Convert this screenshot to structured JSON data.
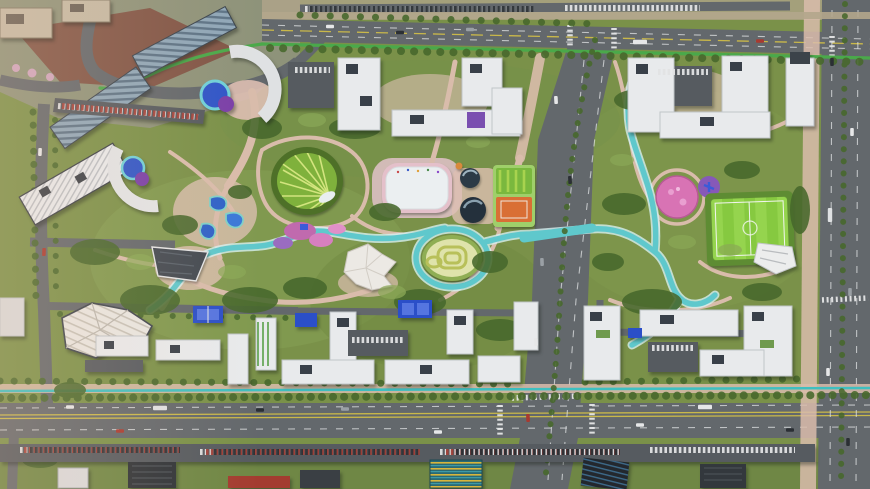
{
  "page": {
    "title": "Aerial masterplan render — residential district with central park"
  },
  "palette": {
    "park_green_base": "#7a9149",
    "tree_dark": "#47682c",
    "tree_light": "#8ba957",
    "hedge_green": "#567c33",
    "median_green": "#5d8036",
    "road_asphalt": "#63686c",
    "parking_asphalt": "#565b60",
    "sidewalk_tan": "#b3a68c",
    "lane_yellow": "#c9b84a",
    "path_pink": "#d9bcab",
    "plaza_pink": "#ddbfb2",
    "stream_teal": "#5fc8cc",
    "bike_green": "#4aa94a",
    "rink_white": "#ebeff1",
    "rink_apron": "#e4c0ca",
    "lawn_green": "#7fb13c",
    "lawn_stripe": "#dcea86",
    "lawn_rim": "#4e7028",
    "court_green": "#7ab83e",
    "court_orange": "#d96f35",
    "court_blue": "#2b4fc8",
    "field_green": "#86c940",
    "field_stripe": "#95d44e",
    "circle_pink": "#d873b4",
    "circle_purple": "#8659b8",
    "maze_hedge": "#b8c05a",
    "maze_bg": "#dfe3ab",
    "building_white": "#e8eaec",
    "building_tan": "#c4b9a4",
    "glass_blue": "#8fa7b8",
    "roof_dark": "#3a4047",
    "school_roof": "#e9e7e2",
    "brick_plaza": "#7e473b",
    "industrial_dark": "#2e3338",
    "industrial_red": "#a33c30",
    "market_teal": "#2a6a74",
    "pavilion_dark": "#2c3a46",
    "car_white": "#e6e7e8",
    "car_dark": "#2b2f34",
    "car_red": "#a83a30",
    "car_silver": "#9aa0a5"
  },
  "legend": [
    {
      "feature": "event-lawn-amphitheater",
      "color_key": "lawn_green"
    },
    {
      "feature": "ice-rink",
      "color_key": "rink_white"
    },
    {
      "feature": "round-dark-pavilions",
      "color_key": "pavilion_dark"
    },
    {
      "feature": "multisport-court-green",
      "color_key": "court_green"
    },
    {
      "feature": "multisport-court-orange",
      "color_key": "court_orange"
    },
    {
      "feature": "hedge-maze-garden",
      "color_key": "maze_hedge"
    },
    {
      "feature": "origami-pavilion",
      "color_key": "school_roof"
    },
    {
      "feature": "playground-mounds",
      "color_key": "circle_pink"
    },
    {
      "feature": "pink-playground-circle",
      "color_key": "circle_pink"
    },
    {
      "feature": "purple-playground-circle",
      "color_key": "circle_purple"
    },
    {
      "feature": "soccer-field",
      "color_key": "field_green"
    },
    {
      "feature": "basketball-courts",
      "color_key": "court_blue"
    },
    {
      "feature": "park-stream-greenway",
      "color_key": "stream_teal"
    },
    {
      "feature": "pedestrian-paths",
      "color_key": "path_pink"
    },
    {
      "feature": "cycle-lane",
      "color_key": "bike_green"
    },
    {
      "feature": "north-boulevard",
      "color_key": "road_asphalt"
    },
    {
      "feature": "south-boulevard",
      "color_key": "road_asphalt"
    },
    {
      "feature": "central-avenue",
      "color_key": "road_asphalt"
    },
    {
      "feature": "east-avenue",
      "color_key": "road_asphalt"
    },
    {
      "feature": "residential-blocks",
      "color_key": "building_white"
    },
    {
      "feature": "glass-roof-offices",
      "color_key": "glass_blue"
    },
    {
      "feature": "school-campus",
      "color_key": "school_roof"
    },
    {
      "feature": "industrial-sheds",
      "color_key": "industrial_dark"
    },
    {
      "feature": "parking-areas",
      "color_key": "parking_asphalt"
    }
  ]
}
